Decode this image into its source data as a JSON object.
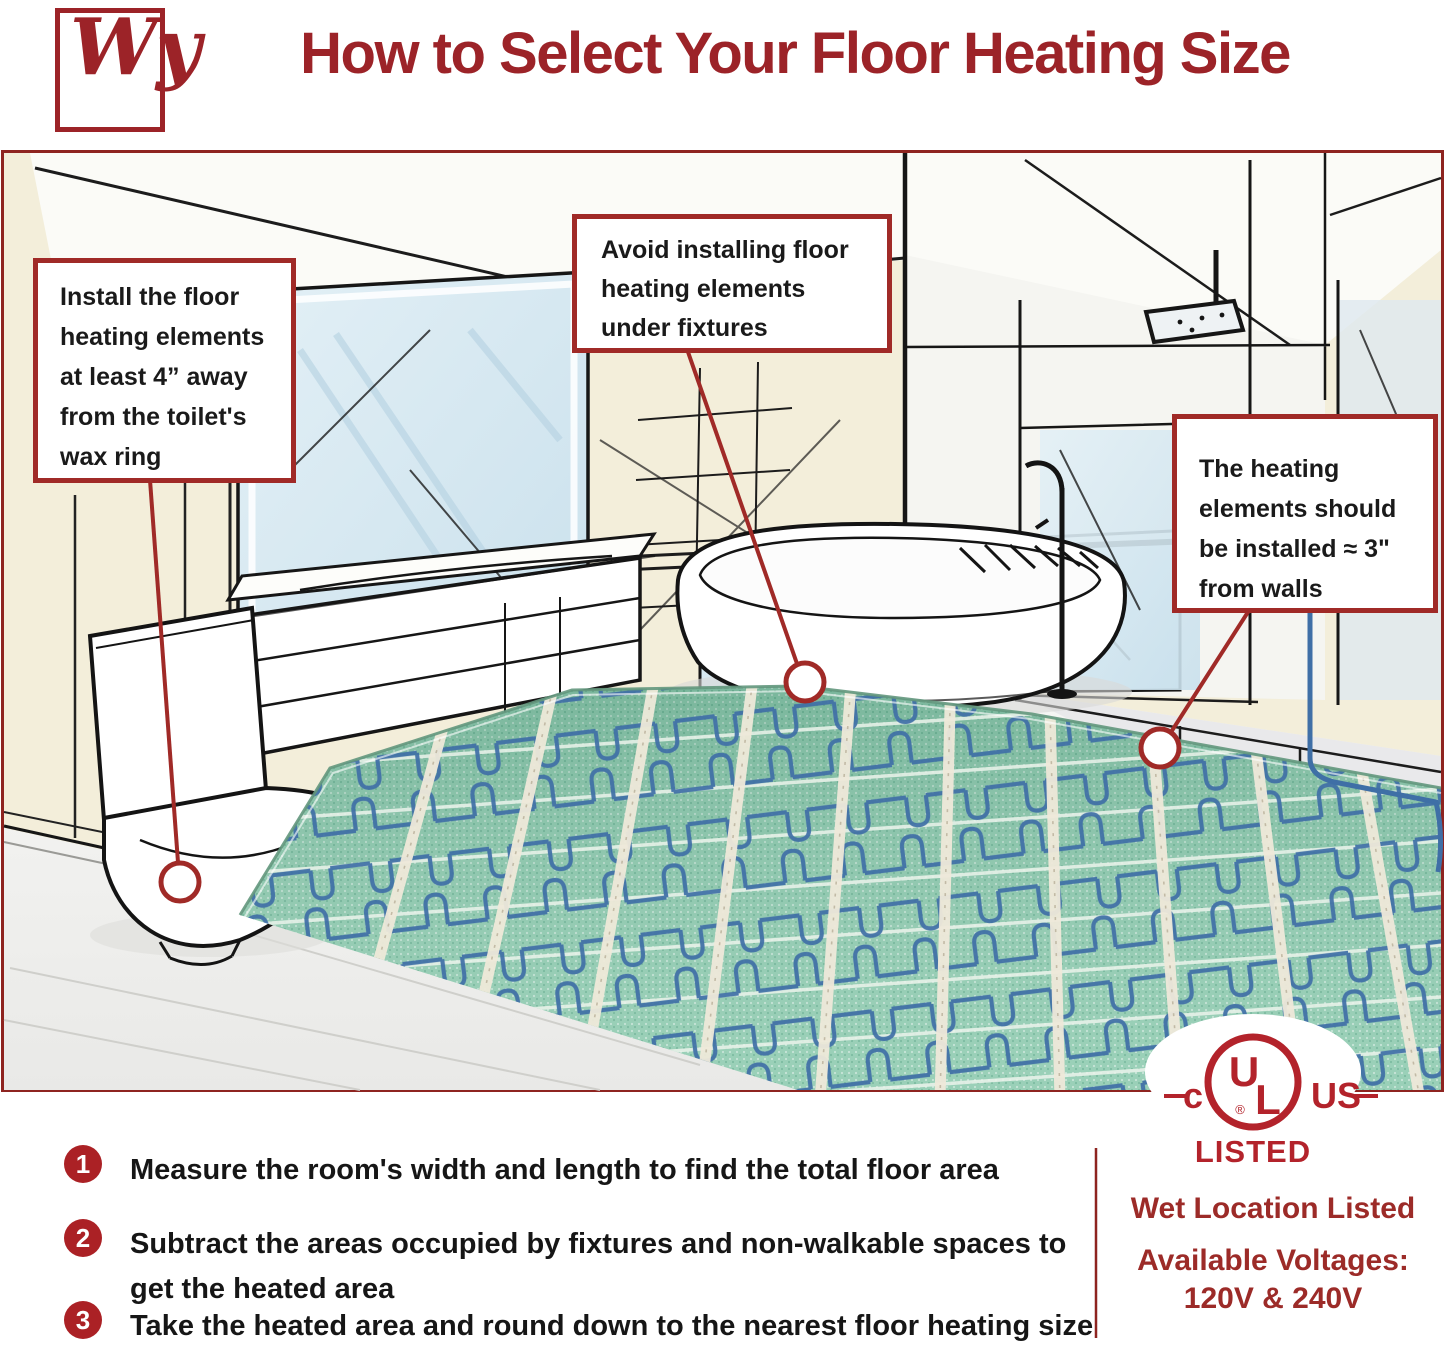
{
  "header": {
    "logo_text": "Wy",
    "title": "How to Select Your Floor Heating Size"
  },
  "callouts": {
    "toilet": "Install the floor heating elements at least 4” away from the toilet's wax ring",
    "fixtures": "Avoid installing floor heating elements under fixtures",
    "walls": "The heating elements should be installed ≈ 3\" from walls"
  },
  "steps": [
    {
      "number": "1",
      "text": "Measure the room's width and length to find the total floor area"
    },
    {
      "number": "2",
      "text": "Subtract the areas occupied by fixtures and non-walkable spaces to get the heated area"
    },
    {
      "number": "3",
      "text": "Take the heated area and round down to the nearest floor heating size"
    }
  ],
  "certification": {
    "ul_c": "c",
    "ul_u": "U",
    "ul_l": "L",
    "ul_r": "®",
    "ul_us": "US",
    "listed": "LISTED",
    "wet_location": "Wet Location Listed",
    "voltages_label": "Available Voltages:",
    "voltages_value": "120V & 240V"
  },
  "colors": {
    "accent_red": "#9c2328",
    "panel_border_red": "#8e2420",
    "wall_cream": "#f3eeda",
    "glass_blue": "#d8e9f2",
    "mat_green": "#8fcbb0",
    "cable_blue": "#3f6fa6"
  }
}
